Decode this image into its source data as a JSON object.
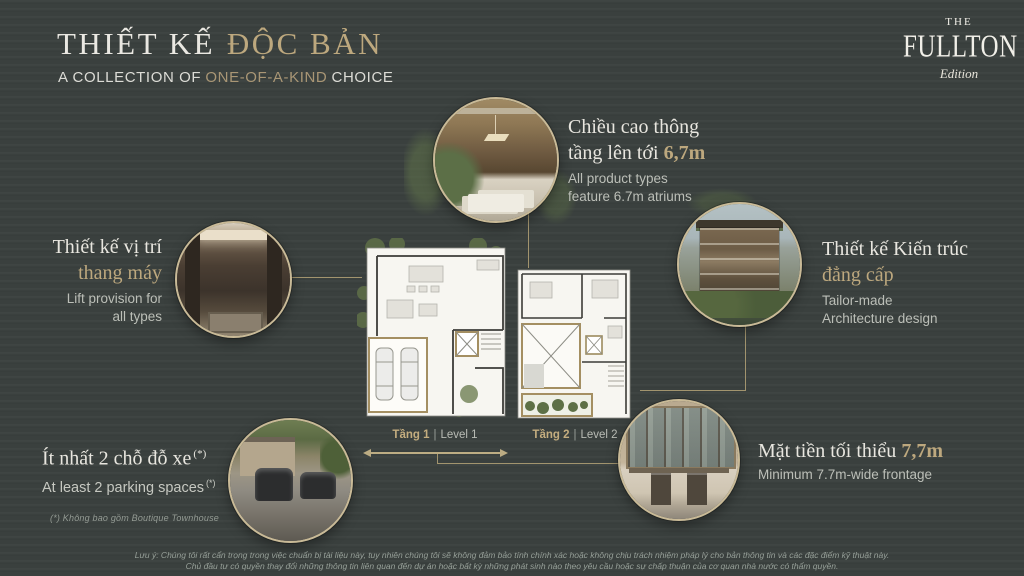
{
  "colors": {
    "background": "#3a403e",
    "accent_gold": "#bda87e",
    "line_gold": "#a2946e",
    "white_text": "#eae8e2",
    "gray_text": "#bcbfb8"
  },
  "header": {
    "title_white": "THIẾT KẾ",
    "title_gold": "ĐỘC BẢN",
    "subtitle_pre": "A COLLECTION OF",
    "subtitle_gold": "ONE-OF-A-KIND",
    "subtitle_post": "CHOICE"
  },
  "logo": {
    "the": "THE",
    "name": "FULLTON",
    "edition": "Edition"
  },
  "callouts": {
    "atrium": {
      "vi_line1": "Chiều cao thông",
      "vi_line2": "tầng lên tới",
      "vi_value": "6,7m",
      "en_line1": "All product types",
      "en_line2": "feature 6.7m atriums"
    },
    "lift": {
      "vi_line1": "Thiết kế vị trí",
      "vi_line2": "thang máy",
      "en_line1": "Lift provision for",
      "en_line2": "all types"
    },
    "architecture": {
      "vi_line1": "Thiết kế Kiến trúc",
      "vi_line2": "đẳng cấp",
      "en_line1": "Tailor-made",
      "en_line2": "Architecture design"
    },
    "parking": {
      "vi": "Ít nhất 2 chỗ đỗ xe",
      "vi_note": "(*)",
      "en": "At least 2 parking spaces",
      "en_note": "(*)"
    },
    "frontage": {
      "vi": "Mặt tiền tối thiểu",
      "vi_value": "7,7m",
      "en": "Minimum 7.7m-wide frontage"
    }
  },
  "floor_plans": {
    "level1": {
      "label_vi": "Tầng 1",
      "divider": "|",
      "label_en": "Level 1"
    },
    "level2": {
      "label_vi": "Tầng 2",
      "divider": "|",
      "label_en": "Level 2"
    }
  },
  "images": {
    "top_circle": "atrium-interior-photo",
    "left_circle": "elevator-interior-photo",
    "right_circle": "villa-exterior-photo",
    "bottom_left_circle": "parking-driveway-photo",
    "bottom_right_circle": "storefront-facade-photo"
  },
  "footnote": "(*) Không bao gồm Boutique Townhouse",
  "disclaimer": {
    "line1": "Lưu ý: Chúng tôi rất cẩn trọng trong việc chuẩn bị tài liệu này, tuy nhiên chúng tôi sẽ không đảm bảo tính chính xác hoặc không chịu trách nhiệm pháp lý cho bản thông tin và các đặc điểm kỹ thuật này.",
    "line2": "Chủ đầu tư có quyền thay đổi những thông tin liên quan đến dự án hoặc bất kỳ những phát sinh nào theo yêu cầu hoặc sự chấp thuận của cơ quan nhà nước có thẩm quyền."
  }
}
